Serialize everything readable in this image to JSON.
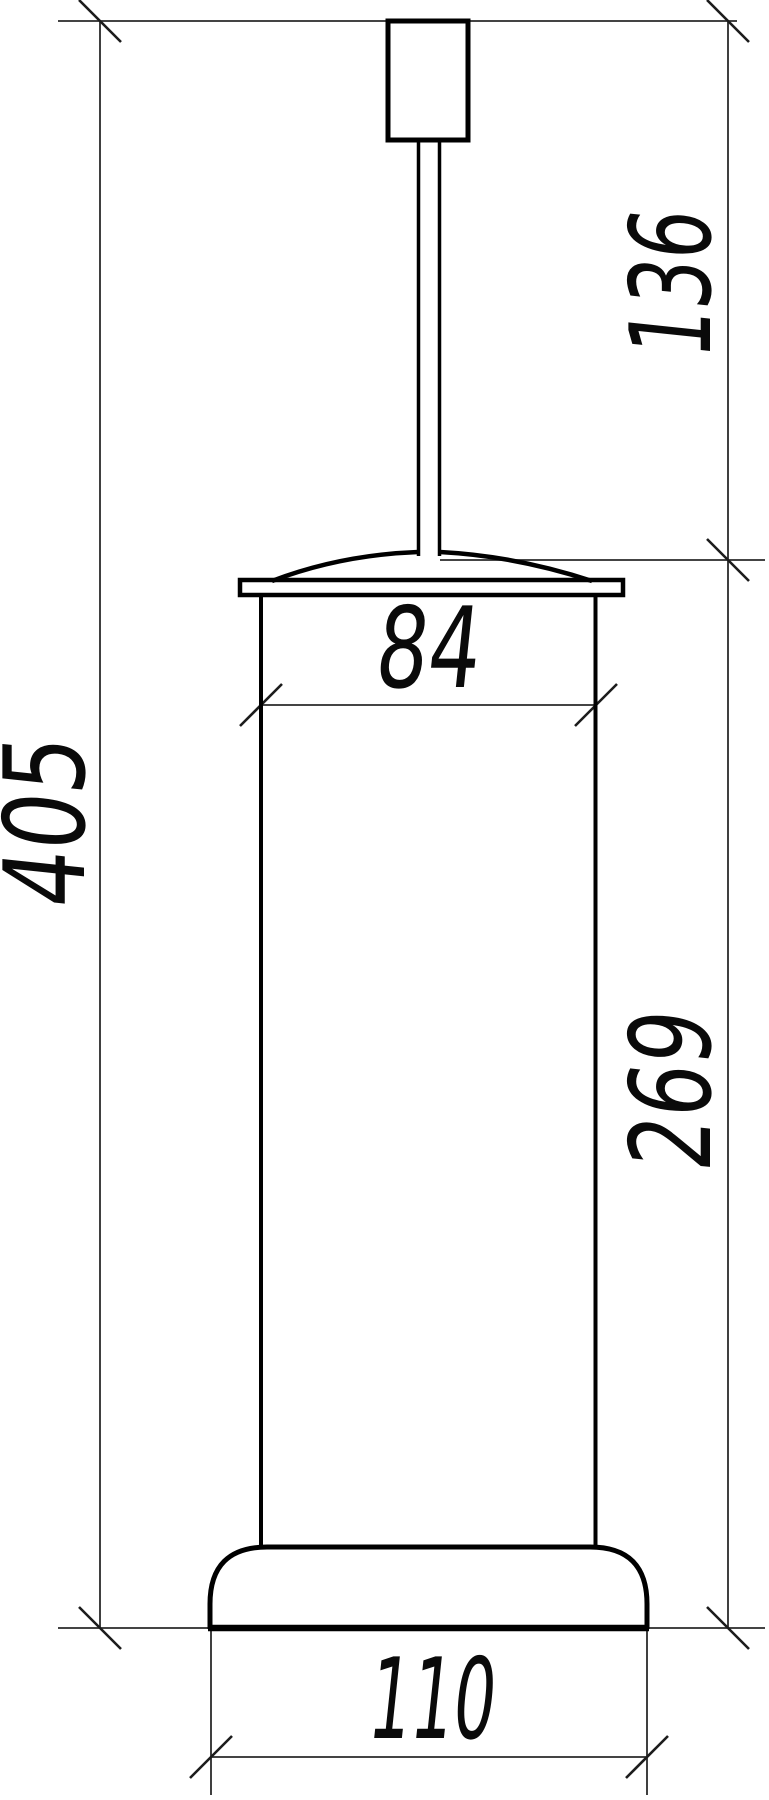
{
  "drawing": {
    "kind": "dimensioned elevation line drawing",
    "colors": {
      "background": "#ffffff",
      "object_line": "#000000",
      "dimension_line": "#2a2a2a",
      "text": "#0a0a0a"
    },
    "dimensions": {
      "overall_height": {
        "label": "405",
        "orientation": "vertical-left"
      },
      "upper_section_height": {
        "label": "136",
        "orientation": "vertical-right-top"
      },
      "body_height": {
        "label": "269",
        "orientation": "vertical-right-bottom"
      },
      "body_width": {
        "label": "84",
        "orientation": "horizontal-top"
      },
      "base_width": {
        "label": "110",
        "orientation": "horizontal-bottom"
      }
    }
  }
}
